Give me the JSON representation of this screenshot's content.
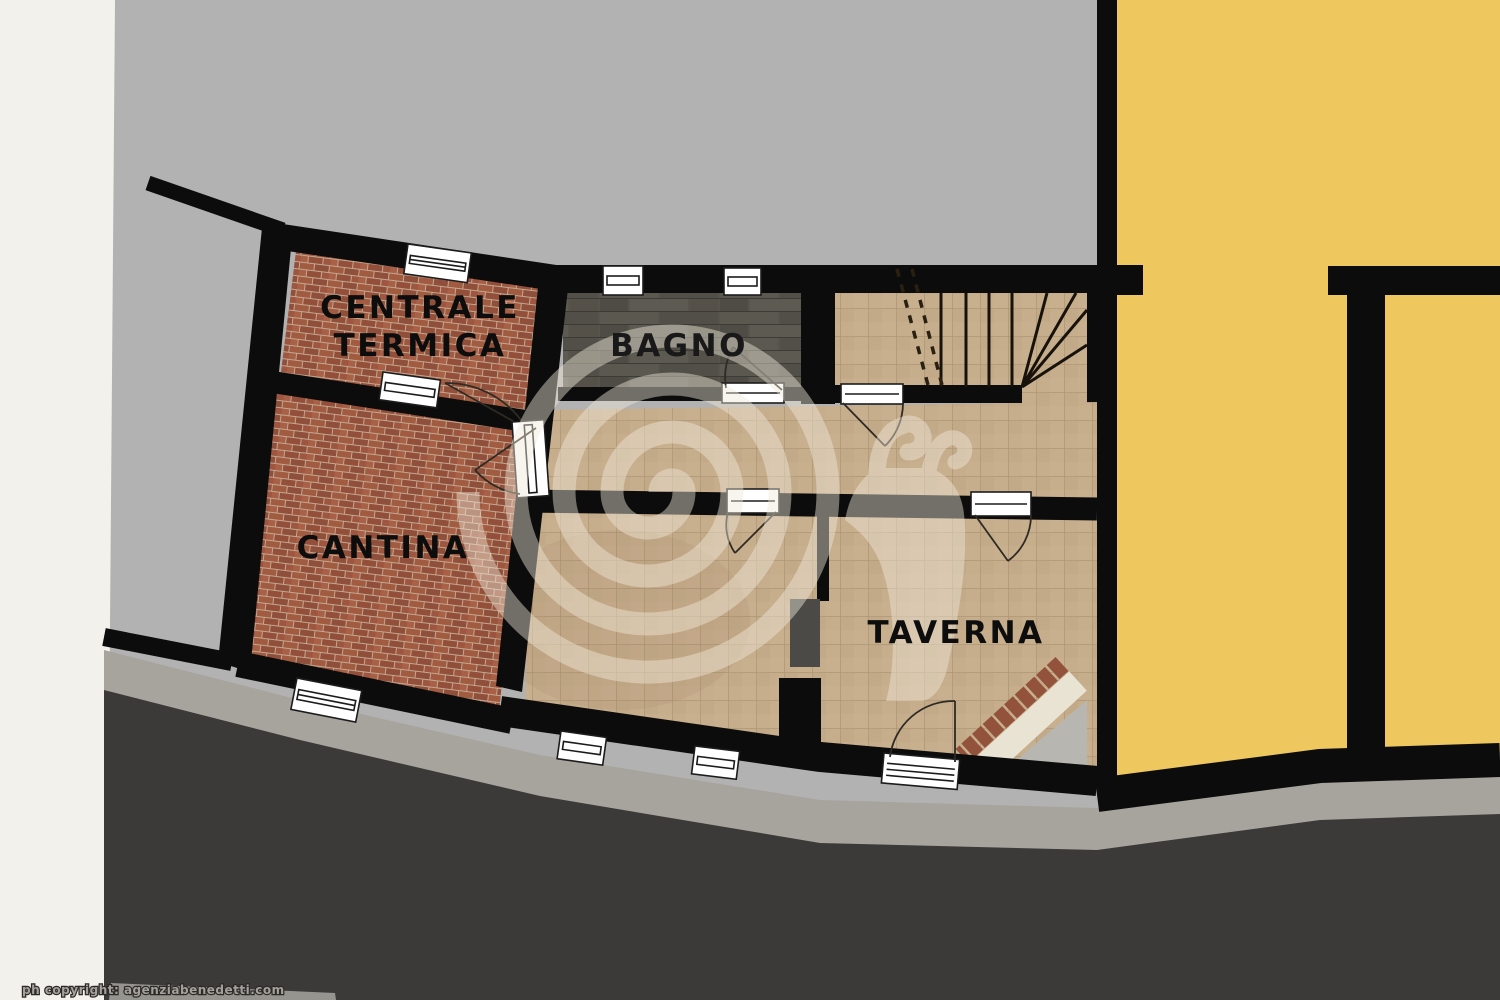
{
  "floorplan": {
    "labels": {
      "centrale_termica_line1": "CENTRALE",
      "centrale_termica_line2": "TERMICA",
      "cantina": "CANTINA",
      "bagno": "BAGNO",
      "taverna": "TAVERNA"
    },
    "copyright": "ph copyright: agenziabenedetti.com",
    "watermark_icon": "snail-logo",
    "colors": {
      "background_gray": "#b3b2b2",
      "paper_white": "#f2f1eb",
      "wall_black": "#0c0c0c",
      "yellow_room": "#eec85e",
      "tan_floor": "#c6ad8c",
      "tan_grid": "#aa9170",
      "brick_floor": "#9d5841",
      "brick_mortar": "#c3a78f",
      "slate_floor": "#57544c",
      "terrain_dark": "#3b3a39",
      "path_gray": "#a7a49e",
      "fireplace_cream": "#e9e3d3",
      "fireplace_brick": "#93523c",
      "corner_gray": "#b8b6b1"
    }
  }
}
